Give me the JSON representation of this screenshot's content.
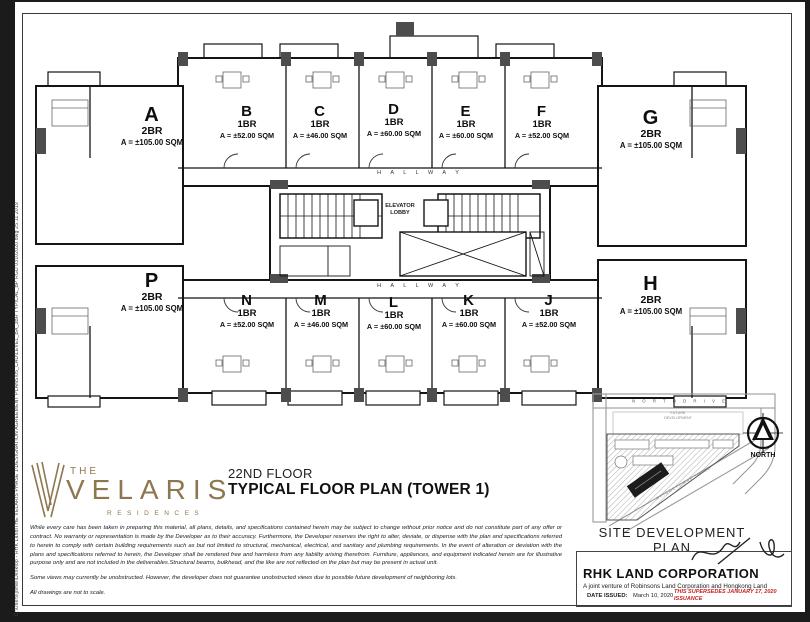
{
  "page": {
    "plot_stamp": "C:\\Users\\jomel\\Desktop - RHK Land\\THE VELARIS PHASE 1\\DESIGNATION AGREEMENT PLANS\\05_CAD\\LEVEL_BA_3BR TYPICAL_BP RGD 03102020.dwg        25.11.2019"
  },
  "floor_plan": {
    "hallway_top": "H A L L W A Y",
    "hallway_bottom": "H A L L W A Y",
    "elevator_lobby_line1": "ELEVATOR",
    "elevator_lobby_line2": "LOBBY",
    "units_top": [
      {
        "letter": "A",
        "type": "2BR",
        "area": "A = ±105.00 SQM"
      },
      {
        "letter": "B",
        "type": "1BR",
        "area": "A = ±52.00 SQM"
      },
      {
        "letter": "C",
        "type": "1BR",
        "area": "A = ±46.00 SQM"
      },
      {
        "letter": "D",
        "type": "1BR",
        "area": "A = ±60.00 SQM"
      },
      {
        "letter": "E",
        "type": "1BR",
        "area": "A = ±60.00 SQM"
      },
      {
        "letter": "F",
        "type": "1BR",
        "area": "A = ±52.00 SQM"
      },
      {
        "letter": "G",
        "type": "2BR",
        "area": "A = ±105.00 SQM"
      }
    ],
    "units_bottom": [
      {
        "letter": "P",
        "type": "2BR",
        "area": "A = ±105.00 SQM"
      },
      {
        "letter": "N",
        "type": "1BR",
        "area": "A = ±52.00 SQM"
      },
      {
        "letter": "M",
        "type": "1BR",
        "area": "A = ±46.00 SQM"
      },
      {
        "letter": "L",
        "type": "1BR",
        "area": "A = ±60.00 SQM"
      },
      {
        "letter": "K",
        "type": "1BR",
        "area": "A = ±60.00 SQM"
      },
      {
        "letter": "J",
        "type": "1BR",
        "area": "A = ±52.00 SQM"
      },
      {
        "letter": "H",
        "type": "2BR",
        "area": "A = ±105.00 SQM"
      }
    ]
  },
  "branding": {
    "the": "THE",
    "name": "VELARIS",
    "residences": "RESIDENCES"
  },
  "title_block": {
    "floor_label": "22ND FLOOR",
    "plan_title": "TYPICAL FLOOR PLAN (TOWER 1)"
  },
  "disclaimer": {
    "p1": "While every care has been taken in preparing this material, all plans, details, and specifications contained herein may be subject to change without prior notice and do not constitute part of any offer or contract. No warranty or representation is made by the Developer as to their accuracy. Furthermore, the Developer reserves the right to alter, deviate, or dispense with the plan and specifications referred to herein to comply with certain building requirements such as but not limited to structural, mechanical, electrical, and sanitary and plumbing requirements. In the event of alteration or deviation with the plans and specifications referred to herein, the Developer shall be rendered free and harmless from any liability arising therefrom. Furniture, appliances, and equipment indicated herein are for illustrative purpose only and are not included in the deliverables.Structural beams, bulkhead, and the like are not reflected on the plan but may be present in actual unit.",
    "p2": "Some views may currently be unobstructed. However, the developer does not guarantee unobstructed views due to possible future development of neighboring lots.",
    "p3": "All drawings are not to scale."
  },
  "site_plan": {
    "heading": "SITE DEVELOPMENT PLAN",
    "north_drive": "N O R T H   D R I V E",
    "future_line1": "FUTURE",
    "future_line2": "DEVELOPMENT",
    "road_diagonal": "BRIDGETOWNE DRIVE",
    "north_label": "NORTH"
  },
  "company": {
    "name": "RHK LAND CORPORATION",
    "joint_venture": "A joint venture of Robinsons Land Corporation and Hongkong Land",
    "date_label": "DATE ISSUED:",
    "date_value": "March 10, 2020",
    "supersedes_line1": "THIS SUPERSEDES JANUARY 17, 2020",
    "supersedes_line2": "ISSUANCE"
  },
  "colors": {
    "brand_gold": "#8e774e",
    "supersedes_red": "#c91f1f",
    "line_black": "#151515"
  }
}
